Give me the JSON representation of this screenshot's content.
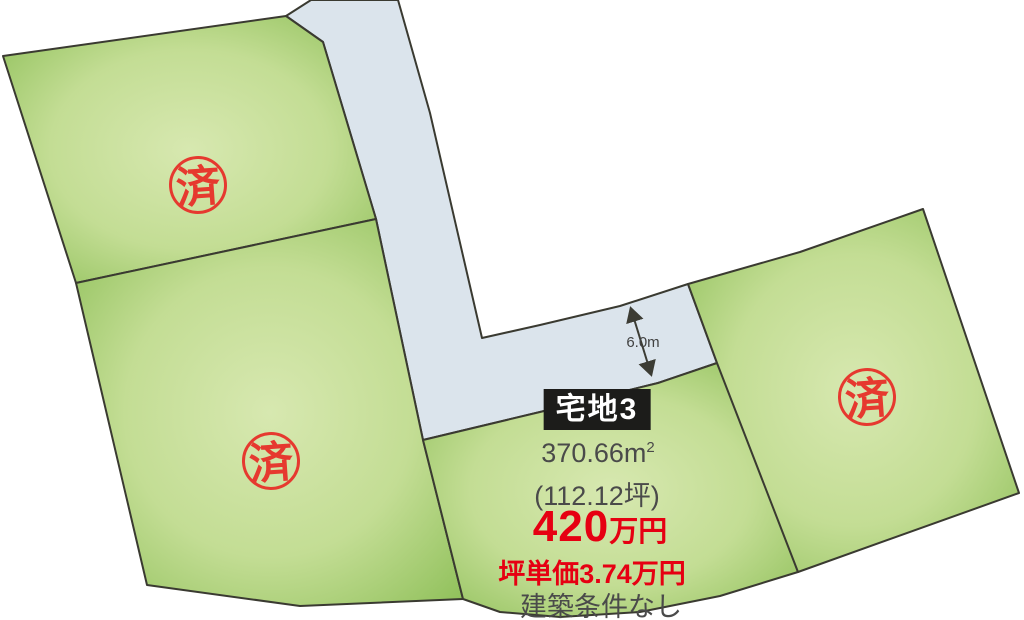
{
  "diagram": {
    "type": "land-plot-map",
    "colors": {
      "background": "#ffffff",
      "road_fill": "#dbe4ec",
      "plot_gradient_center": "#d7e8b0",
      "plot_gradient_edge": "#8cbe56",
      "boundary_line": "#3a3a31",
      "stamp_red": "#e6392f",
      "price_red": "#e60012",
      "text_gray": "#4a4a4a",
      "badge_black": "#1c1c1a"
    }
  },
  "road": {
    "width_label": "6.0m"
  },
  "stamps": [
    {
      "label": "済"
    },
    {
      "label": "済"
    },
    {
      "label": "済"
    }
  ],
  "lot3": {
    "name": "宅地3",
    "area_main": "370.66m",
    "area_sup": "2",
    "area_tsubo": "(112.12坪)",
    "price_value": "420",
    "price_unit": "万円",
    "unit_price": "坪単価3.74万円",
    "note": "建築条件なし"
  }
}
